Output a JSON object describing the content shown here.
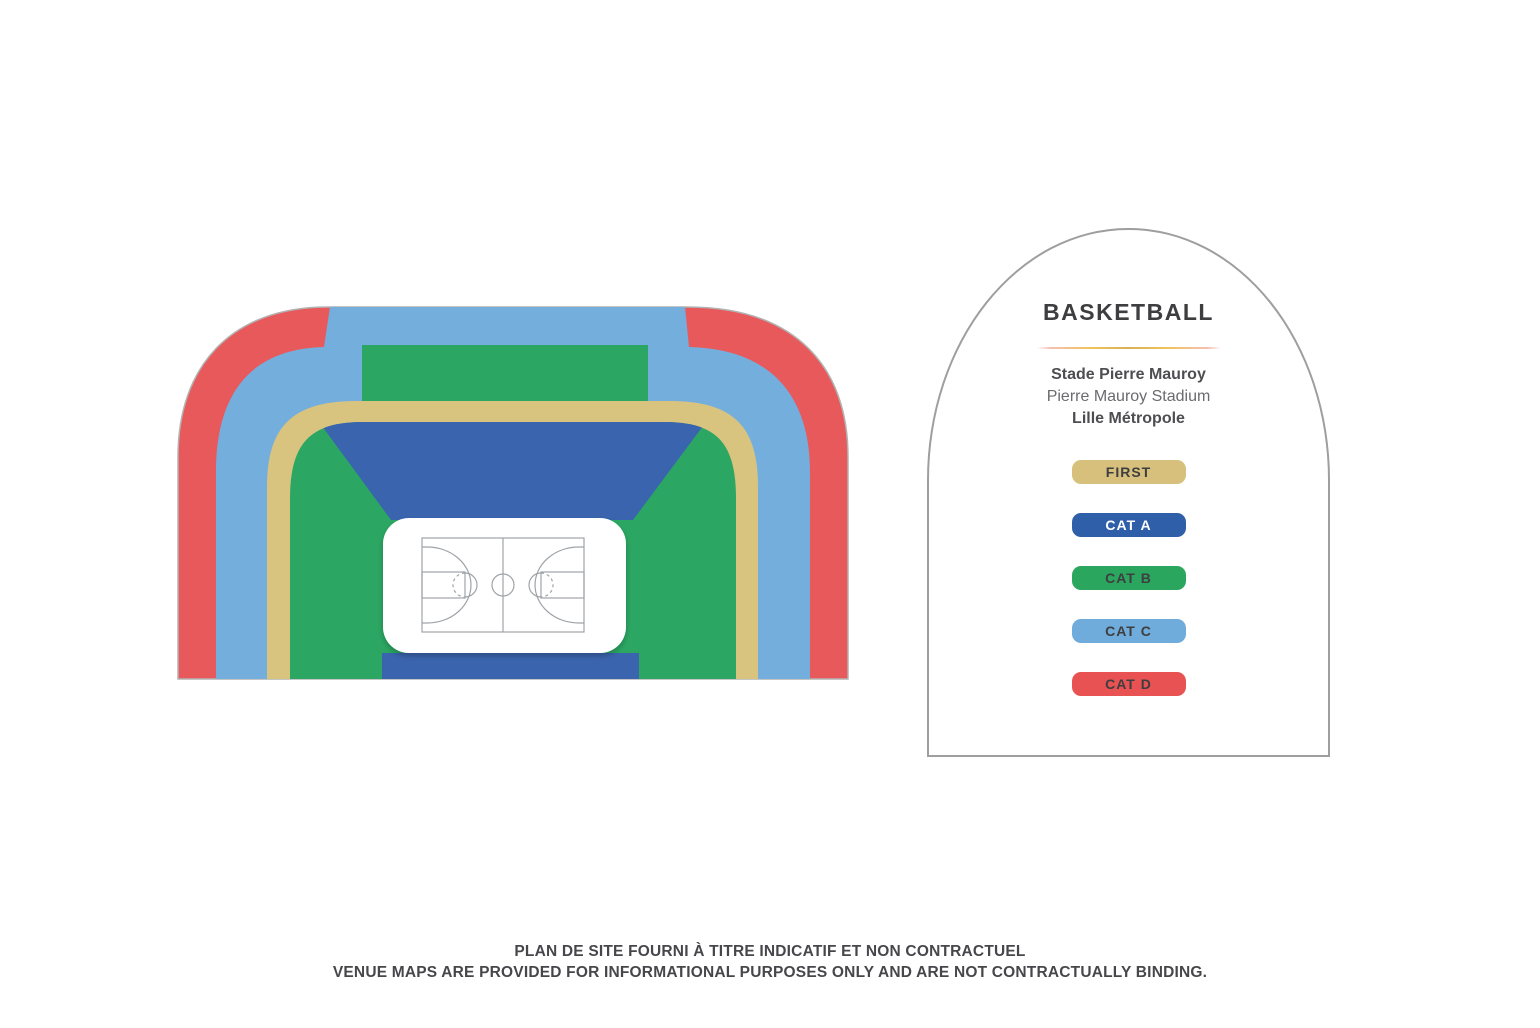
{
  "legend_card": {
    "title": "BASKETBALL",
    "venue": {
      "name_fr": "Stade Pierre Mauroy",
      "name_en": "Pierre Mauroy Stadium",
      "city": "Lille Métropole"
    },
    "categories": [
      {
        "label": "FIRST",
        "color": "#D6C07C",
        "text_color": "#3E3E40"
      },
      {
        "label": "CAT A",
        "color": "#2F5FA8",
        "text_color": "#FFFFFF"
      },
      {
        "label": "CAT B",
        "color": "#2BA65F",
        "text_color": "#3E3E40"
      },
      {
        "label": "CAT C",
        "color": "#6FACDC",
        "text_color": "#3E3E40"
      },
      {
        "label": "CAT D",
        "color": "#E85253",
        "text_color": "#3E3E40"
      }
    ]
  },
  "map": {
    "sport": "basketball",
    "sections": {
      "first": {
        "label": "FIRST",
        "color": "#D9C47F"
      },
      "cat_a": {
        "label": "CAT A",
        "color": "#3A64AE"
      },
      "cat_b": {
        "label": "CAT B",
        "color": "#2CA763"
      },
      "cat_c": {
        "label": "CAT C",
        "color": "#74AEDD"
      },
      "cat_d": {
        "label": "CAT D",
        "color": "#E8595B"
      }
    },
    "court_fill": "#FFFFFF",
    "court_line_color": "#9FA3A8"
  },
  "footer": {
    "disclaimer_fr": "PLAN DE SITE FOURNI À TITRE INDICATIF ET NON CONTRACTUEL",
    "disclaimer_en": "VENUE MAPS ARE PROVIDED FOR INFORMATIONAL PURPOSES ONLY AND ARE NOT CONTRACTUALLY BINDING."
  }
}
